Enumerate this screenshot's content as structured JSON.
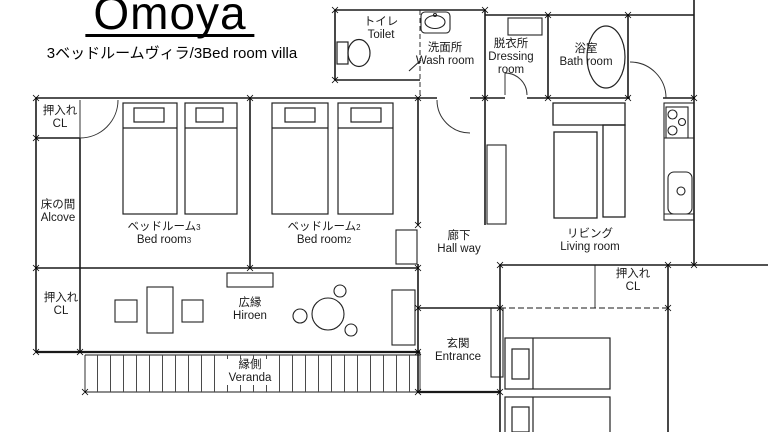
{
  "title": {
    "text": "Omoya",
    "subtitle": "3ベッドルームヴィラ/3Bed room villa"
  },
  "rooms": {
    "toilet": {
      "jp": "トイレ",
      "en": "Toilet"
    },
    "wash_room": {
      "jp": "洗面所",
      "en": "Wash room"
    },
    "dressing_room": {
      "jp": "脱衣所",
      "en1": "Dressing",
      "en2": "room"
    },
    "bath_room": {
      "jp": "浴室",
      "en": "Bath room"
    },
    "bedroom3": {
      "jp": "ベッドルーム",
      "jp_num": "3",
      "en": "Bed room",
      "en_num": "3"
    },
    "bedroom2": {
      "jp": "ベッドルーム",
      "jp_num": "2",
      "en": "Bed room",
      "en_num": "2"
    },
    "hallway": {
      "jp": "廊下",
      "en": "Hall way"
    },
    "living_room": {
      "jp": "リビング",
      "en": "Living room"
    },
    "closet_top_left": {
      "jp": "押入れ",
      "en": "CL"
    },
    "alcove": {
      "jp": "床の間",
      "en": "Alcove"
    },
    "closet_bottom_left": {
      "jp": "押入れ",
      "en": "CL"
    },
    "closet_right": {
      "jp": "押入れ",
      "en": "CL"
    },
    "hiroen": {
      "jp": "広縁",
      "en": "Hiroen"
    },
    "veranda": {
      "jp": "縁側",
      "en": "Veranda"
    },
    "entrance": {
      "jp": "玄関",
      "en": "Entrance"
    }
  },
  "colors": {
    "background": "#ffffff",
    "line": "#1a1a1a"
  }
}
